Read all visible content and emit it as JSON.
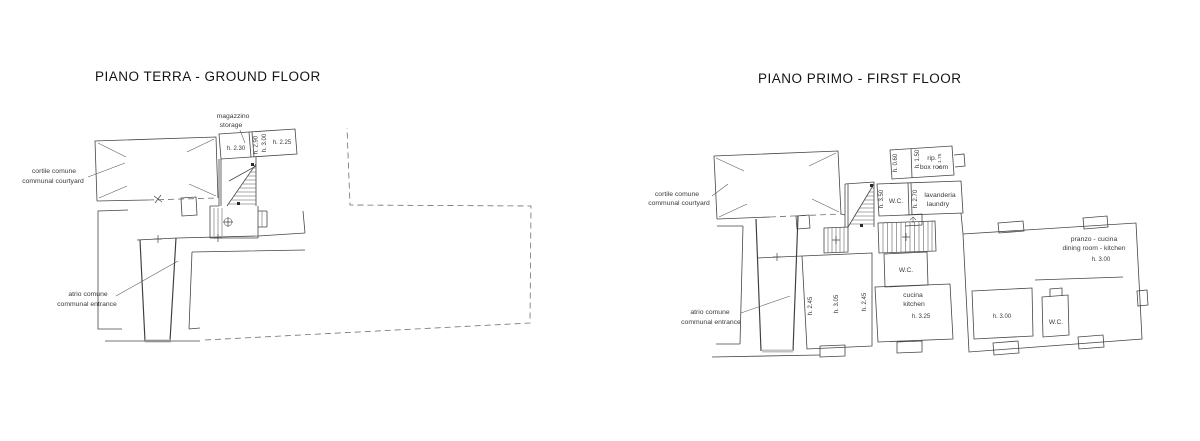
{
  "plans": {
    "ground": {
      "title": "PIANO TERRA - GROUND FLOOR",
      "courtyard": {
        "it": "cortile comune",
        "en": "communal courtyard"
      },
      "storage": {
        "it": "magazzino",
        "en": "storage"
      },
      "entrance": {
        "it": "atrio comune",
        "en": "communal entrance"
      },
      "heights": {
        "room1": "h. 2.30",
        "room2": "h. 2.90",
        "room3": "h. 3.00",
        "room4": "h. 2.25"
      }
    },
    "first": {
      "title": "PIANO PRIMO - FIRST FLOOR",
      "courtyard": {
        "it": "cortile comune",
        "en": "communal courtyard"
      },
      "entrance": {
        "it": "atrio comune",
        "en": "communal entrance"
      },
      "box_room": {
        "it": "rip.",
        "en": "box room",
        "h_low": "h. 0.60",
        "h_mid": "h. 1.50",
        "h_top": "h. 1.75"
      },
      "laundry": {
        "wc": "W.C.",
        "h_wc": "h. 3.50",
        "h": "h. 2.70",
        "it": "lavanderia",
        "en": "laundry"
      },
      "left_rooms": {
        "h1": "h. 2.45",
        "h2": "h. 3.05",
        "h3": "h. 2.45"
      },
      "kitchen": {
        "wc": "W.C.",
        "it": "cucina",
        "en": "kitchen",
        "h": "h. 3.25"
      },
      "dining": {
        "it": "pranzo - cucina",
        "en": "dining room - kitchen",
        "h": "h. 3.00"
      },
      "room_right": {
        "h": "h. 3.00",
        "wc": "W.C."
      }
    }
  }
}
